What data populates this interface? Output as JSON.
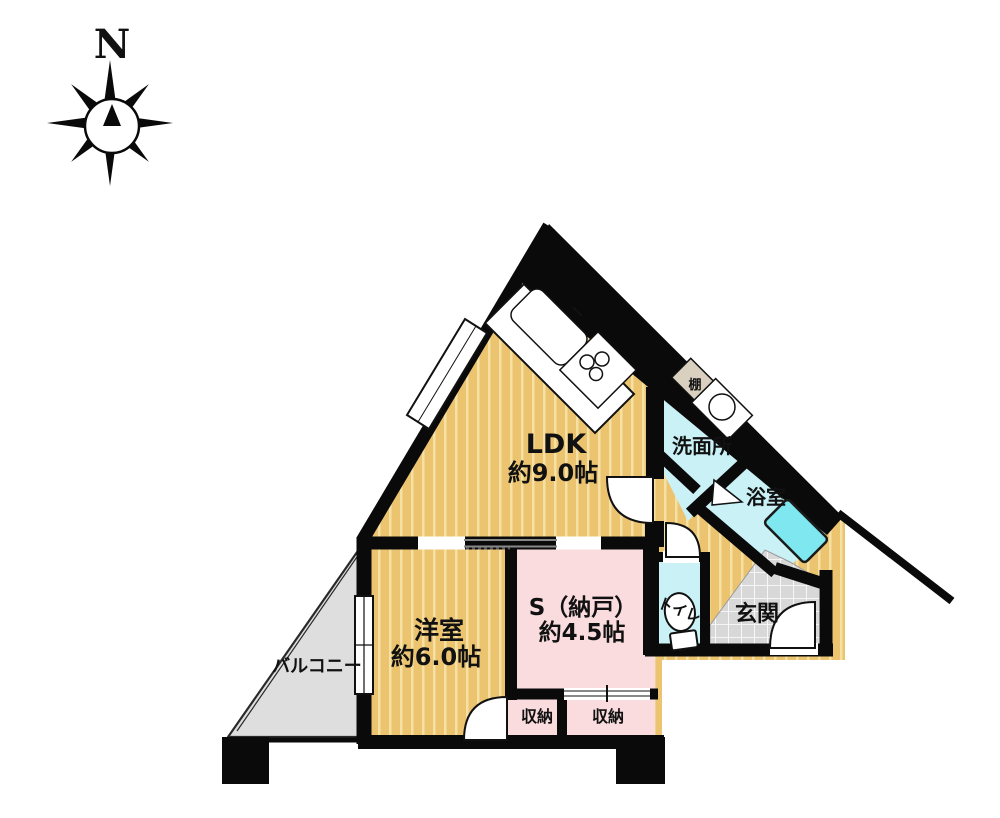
{
  "compass": {
    "north_label": "N"
  },
  "rooms": {
    "ldk": {
      "name": "LDK",
      "size": "約9.0帖"
    },
    "washroom": {
      "name": "洗面所"
    },
    "bathroom": {
      "name": "浴室"
    },
    "western_room": {
      "name": "洋室",
      "size": "約6.0帖"
    },
    "storage_room": {
      "name": "S（納戸）",
      "size": "約4.5帖"
    },
    "toilet": {
      "name": "トイレ"
    },
    "entrance": {
      "name": "玄関"
    },
    "balcony": {
      "name": "バルコニー"
    },
    "closet_left": {
      "name": "収納"
    },
    "closet_right": {
      "name": "収納"
    },
    "shelf": {
      "name": "棚"
    }
  },
  "colors": {
    "wall": "#0a0a0a",
    "floor_wood": "#ecc46f",
    "floor_stripe": "#f6e1a4",
    "room_pink": "#fadcdf",
    "room_cyan": "#c9f1f6",
    "bathtub_cyan": "#7fe7ef",
    "tile_gray": "#d8d8d8",
    "balcony_gray": "#dedede",
    "shelf_beige": "#d9d0c0",
    "fixture_white": "#ffffff"
  }
}
